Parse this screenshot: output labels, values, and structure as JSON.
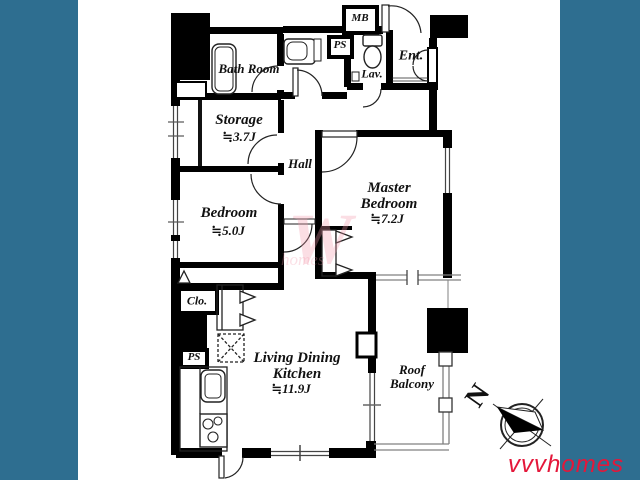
{
  "rooms": {
    "bath": {
      "name": "Bath Room"
    },
    "storage": {
      "name": "Storage",
      "area": "≒3.7J"
    },
    "hall": {
      "name": "Hall"
    },
    "bedroom": {
      "name": "Bedroom",
      "area": "≒5.0J"
    },
    "master": {
      "name": "Master Bedroom",
      "area": "≒7.2J"
    },
    "ldk": {
      "name": "Living Dining Kitchen",
      "area": "≒11.9J"
    },
    "balcony": {
      "name": "Roof Balcony"
    }
  },
  "labels": {
    "mb": "MB",
    "ps_top": "PS",
    "lav": "Lav.",
    "ent": "Ent.",
    "clo": "Clo.",
    "ps_bottom": "PS"
  },
  "compass": {
    "north": "N"
  },
  "watermark": {
    "brand": "vvvhomes",
    "faint_letter": "W",
    "faint_word": "homes"
  },
  "colors": {
    "frame": "#2e6e90",
    "wall": "#000000",
    "brand": "#e4173a"
  }
}
